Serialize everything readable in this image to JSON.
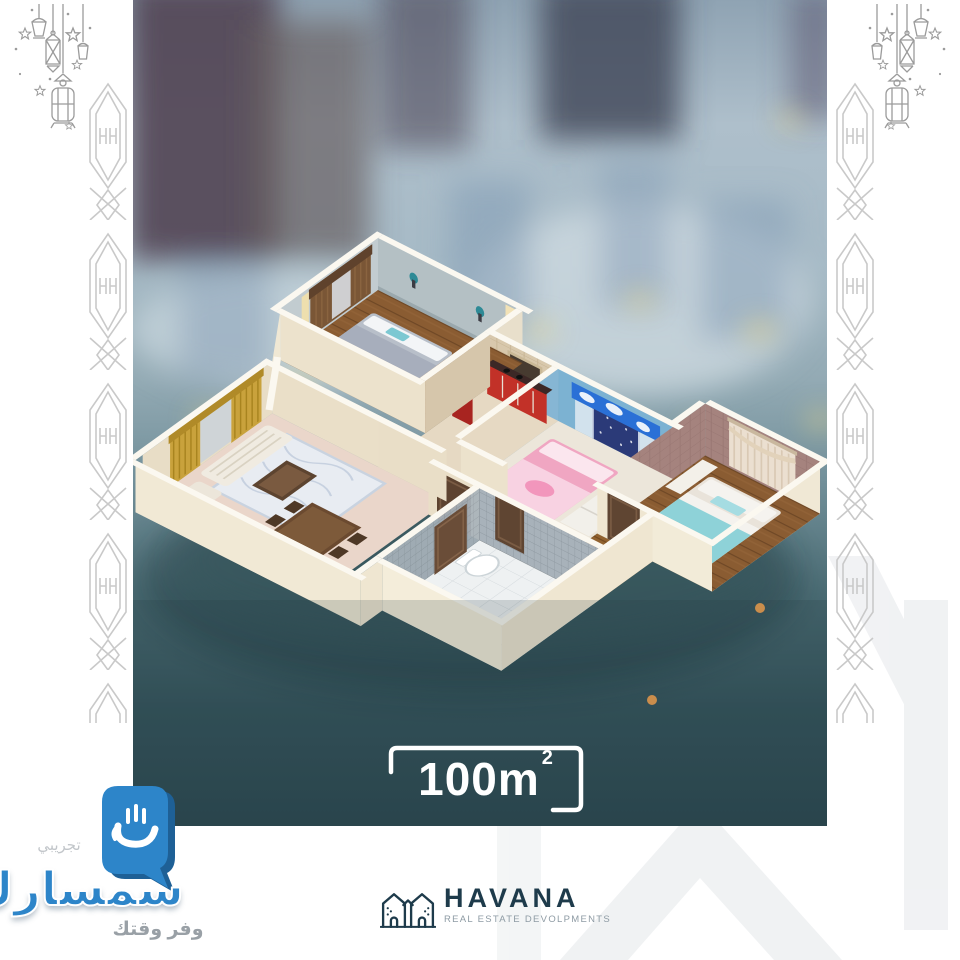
{
  "badge": {
    "value": "100",
    "unit": "m",
    "sup": "2"
  },
  "brand": {
    "name": "HAVANA",
    "tagline": "REAL ESTATE DEVOLPMENTS"
  },
  "watermark": {
    "trial": "تجريبي",
    "name": "سمسارك",
    "tagline": "وفر وقتك"
  },
  "colors": {
    "accent_blue": "#2d85c9",
    "brand_navy": "#1e3b4b",
    "photo_teal": "#2c4850",
    "wall_cream": "#f2ebd8",
    "kids_blue": "#7cb2d2",
    "kitchen_red": "#c23128",
    "ornament_gray": "#c9c9c9"
  },
  "scene": {
    "type": "isometric-floor-plan",
    "rooms": [
      "master-bedroom",
      "living-room",
      "kitchen",
      "kids-bedroom",
      "bathroom",
      "second-bedroom"
    ]
  }
}
